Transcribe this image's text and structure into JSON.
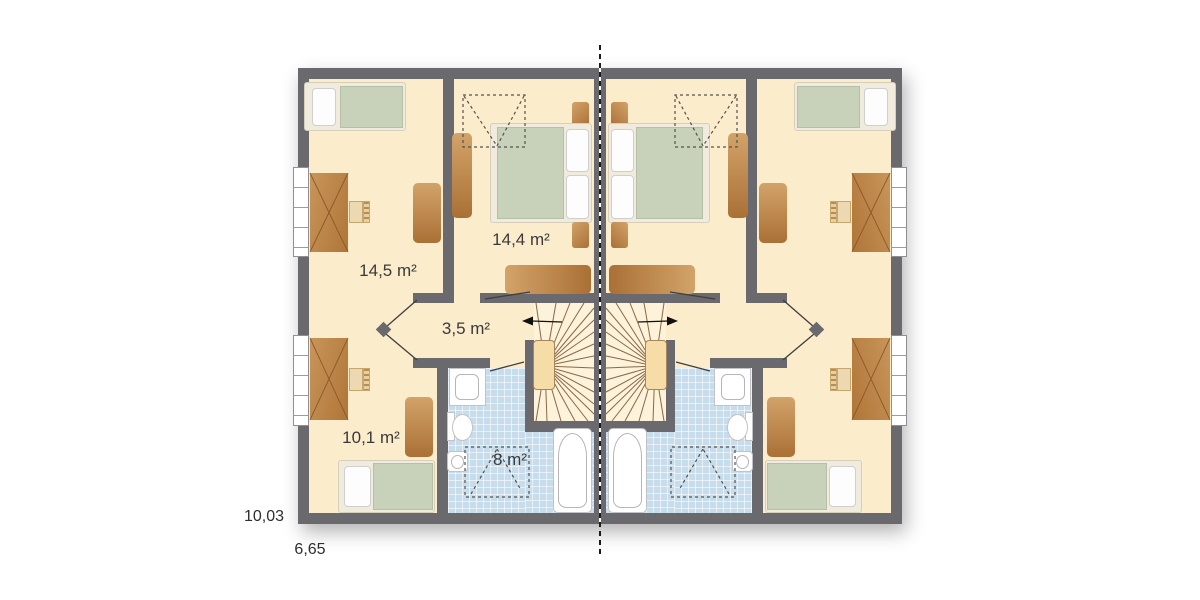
{
  "plan": {
    "kind": "floor-plan",
    "mirrored_duplex": true
  },
  "labels": {
    "room_left_top": {
      "text": "14,5 m²"
    },
    "room_center_top": {
      "text": "14,4 m²"
    },
    "hallway": {
      "text": "3,5 m²"
    },
    "room_left_bottom": {
      "text": "10,1 m²"
    },
    "bathroom": {
      "text": "8 m²"
    }
  },
  "dimensions": {
    "depth": {
      "text": "10,03"
    },
    "width": {
      "text": "6,65"
    }
  },
  "colors": {
    "wall": "#6a6a6e",
    "floor": "#fbeccb",
    "floor_stair": "#fdf2da",
    "tile": "#c7ddeb",
    "furn_a": "#d2a369",
    "furn_b": "#aa7036",
    "bed_green": "#c8d1ba",
    "frame": "#f0ebdc",
    "stair_accent": "#f6dca6",
    "stair_line": "#8a6844",
    "label": "#3a3a3c"
  }
}
